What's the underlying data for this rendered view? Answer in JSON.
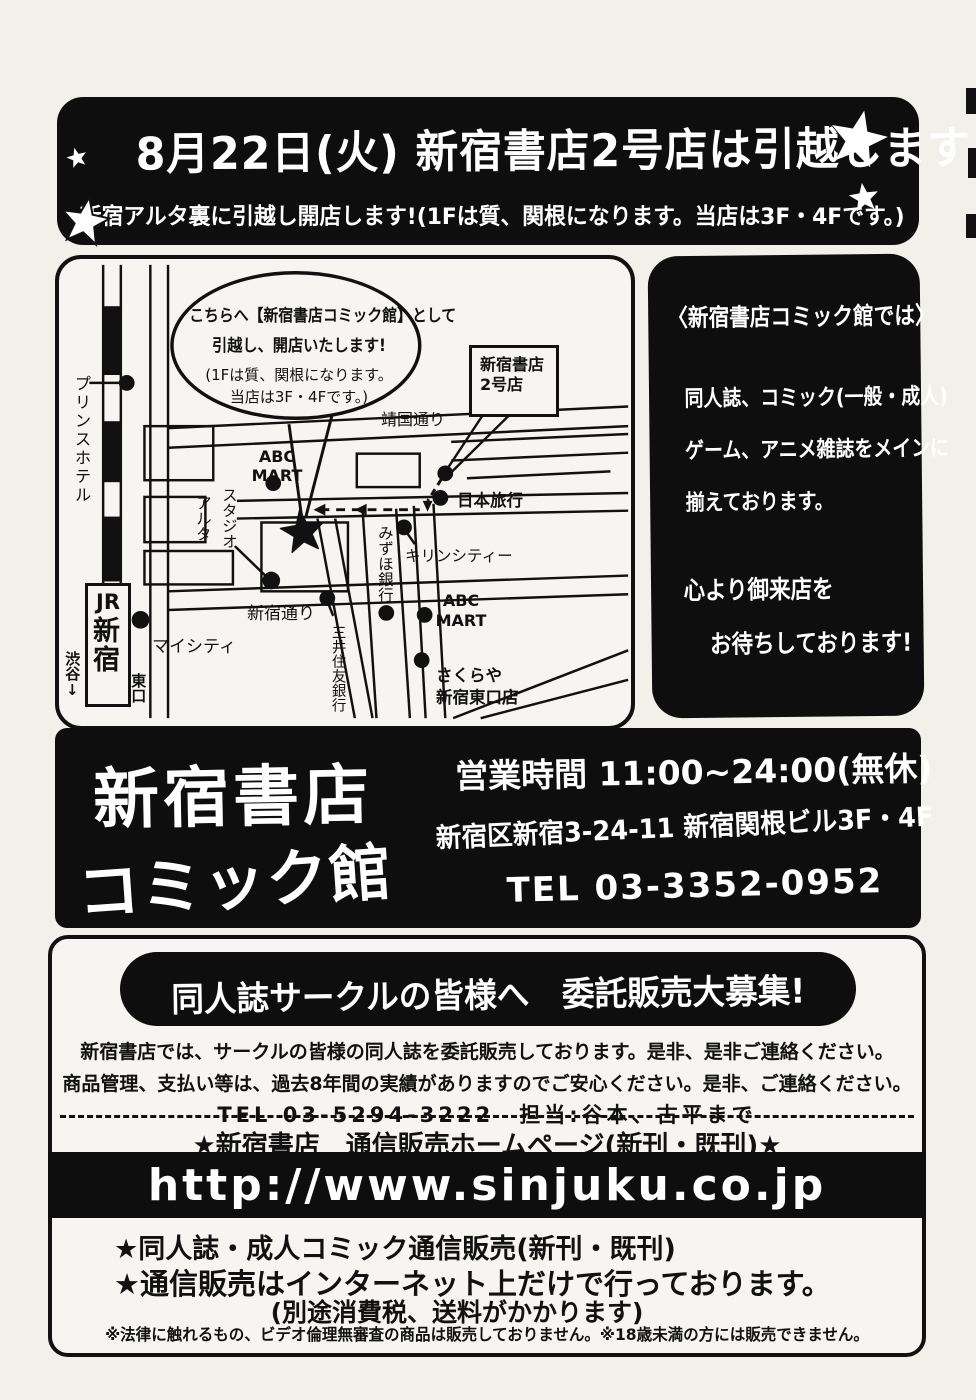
{
  "top_banner": {
    "title": "8月22日(火) 新宿書店2号店は引越します!",
    "subtitle": "新宿アルタ裏に引越し開店します!(1Fは質、関根になります。当店は3F・4Fです。)"
  },
  "map": {
    "balloon": {
      "line1": "こちらへ【新宿書店コミック館】として",
      "line2": "引越し、開店いたします!",
      "line3": "(1Fは質、関根になります。",
      "line4": "当店は3F・4Fです。)"
    },
    "labels": {
      "prince_hotel": "プリンスホテル",
      "jr": "JR",
      "shinjuku_station": "新宿",
      "shibuya": "渋谷↓",
      "east_exit": "東口",
      "my_city": "マイシティ",
      "studio": "スタジオ",
      "alta": "アルタ",
      "abc_left_1": "ABC",
      "abc_left_2": "MART",
      "yasukuni_dori": "靖国通り",
      "shop2_line1": "新宿書店",
      "shop2_line2": "2号店",
      "nihon_ryoko": "日本旅行",
      "mizuho_bank": "みずほ銀行",
      "kirin_city": "キリンシティー",
      "abc_right_1": "ABC",
      "abc_right_2": "MART",
      "shinjuku_dori": "新宿通り",
      "smbc": "三井住友銀行",
      "sakuraya_1": "さくらや",
      "sakuraya_2": "新宿東口店"
    }
  },
  "info_panel": {
    "title": "〈新宿書店コミック館では〉",
    "line1": "同人誌、コミック(一般・成人)",
    "line2": "ゲーム、アニメ雑誌をメインに",
    "line3": "揃えております。",
    "line4": "心より御来店を",
    "line5": "お待ちしております!"
  },
  "store_bar": {
    "name_line1": "新宿書店",
    "name_line2": "コミック館",
    "hours": "営業時間 11:00~24:00(無休)",
    "address": "新宿区新宿3-24-11 新宿関根ビル3F・4F",
    "tel": "TEL 03-3352-0952"
  },
  "consignment": {
    "banner": "同人誌サークルの皆様へ　委託販売大募集!",
    "para1": "新宿書店では、サークルの皆様の同人誌を委託販売しております。是非、是非ご連絡ください。",
    "para2": "商品管理、支払い等は、過去8年間の実績がありますのでご安心ください。是非、ご連絡ください。",
    "tel_line": "TEL 03-5294-3222　担当:谷本、古平まで",
    "homepage_line": "★新宿書店　通信販売ホームページ(新刊・既刊)★",
    "url": "http://www.sinjuku.co.jp",
    "note1": "★同人誌・成人コミック通信販売(新刊・既刊)",
    "note2": "★通信販売はインターネット上だけで行っております。",
    "note3": "(別途消費税、送料がかかります)",
    "disclaimer": "※法律に触れるもの、ビデオ倫理無審査の商品は販売しておりません。※18歳未満の方には販売できません。"
  },
  "colors": {
    "ink": "#111111",
    "paper": "#f2f0eb"
  }
}
